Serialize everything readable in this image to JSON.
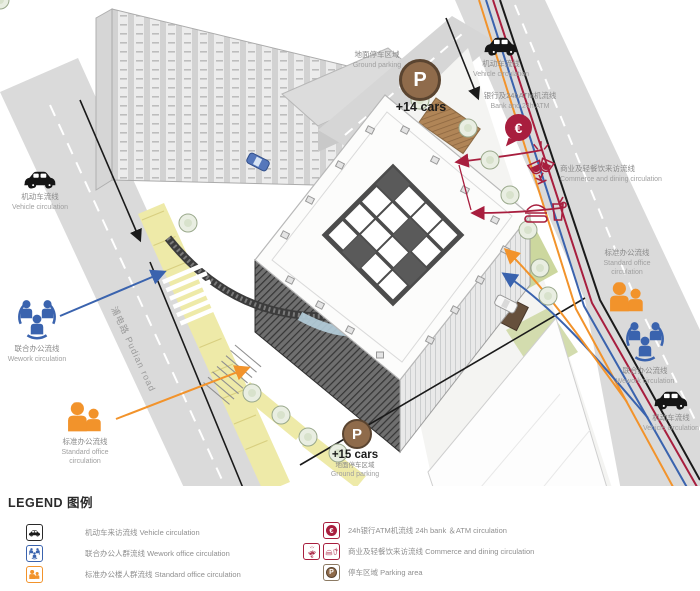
{
  "colors": {
    "vehicle_black": "#1a1a1a",
    "wework_blue": "#3a63ae",
    "standard_orange": "#f2932b",
    "commerce_crimson": "#a81e3e",
    "parking_brown": "#8f6b4b",
    "road_grey": "#dadada",
    "lane_yellow": "#eeeaa8"
  },
  "scene": {
    "road_label": "浦电路 Pudian road"
  },
  "annotations": {
    "vehicle_top_left": {
      "zh": "机动车流线",
      "en": "Vehicle circulation"
    },
    "ground_parking_top": {
      "zh": "地面停车区域",
      "en": "Ground parking",
      "p": "P",
      "count": "+14 cars"
    },
    "vehicle_top_right": {
      "zh": "机动车流线",
      "en": "Vehicle circulation"
    },
    "bank_atm": {
      "zh": "银行及24hATM机流线",
      "en": "Bank and 24h ATM",
      "symbol": "€"
    },
    "commerce_dining": {
      "zh": "商业及轻餐饮来访流线",
      "en": "Commerce and dining circulation"
    },
    "wework_left": {
      "zh": "联合办公流线",
      "en": "Wework circulation"
    },
    "standard_office_left": {
      "zh": "标准办公流线",
      "en_line1": "Standard office",
      "en_line2": "circulation"
    },
    "standard_office_right": {
      "zh": "标准办公流线",
      "en_line1": "Standard office",
      "en_line2": "circulation"
    },
    "wework_right": {
      "zh": "联合办公流线",
      "en": "Wework circulation"
    },
    "vehicle_right": {
      "zh": "机动车流线",
      "en": "Vehicle circulation"
    },
    "ground_parking_bottom": {
      "zh": "地面停车区域",
      "en": "Ground parking",
      "p": "P",
      "count": "+15 cars"
    }
  },
  "legend": {
    "title": "LEGEND 图例",
    "symbols": {
      "euro": "€",
      "parking": "P"
    },
    "items_left": [
      {
        "icon": "car-icon",
        "text": "机动车来访流线 Vehicle circulation"
      },
      {
        "icon": "wework-group-icon",
        "text": "联合办公人群流线 Wework office circulation"
      },
      {
        "icon": "standard-office-group-icon",
        "text": "标准办公楼人群流线 Standard office circulation"
      }
    ],
    "items_right": [
      {
        "icon": "bank-atm-icon",
        "text": "24h银行ATM机流线 24h bank ＆ATM circulation"
      },
      {
        "icon": "dining-icons",
        "text": "商业及轻餐饮来访流线 Commerce and dining circulation"
      },
      {
        "icon": "parking-icon",
        "text": "停车区域 Parking area"
      }
    ]
  }
}
